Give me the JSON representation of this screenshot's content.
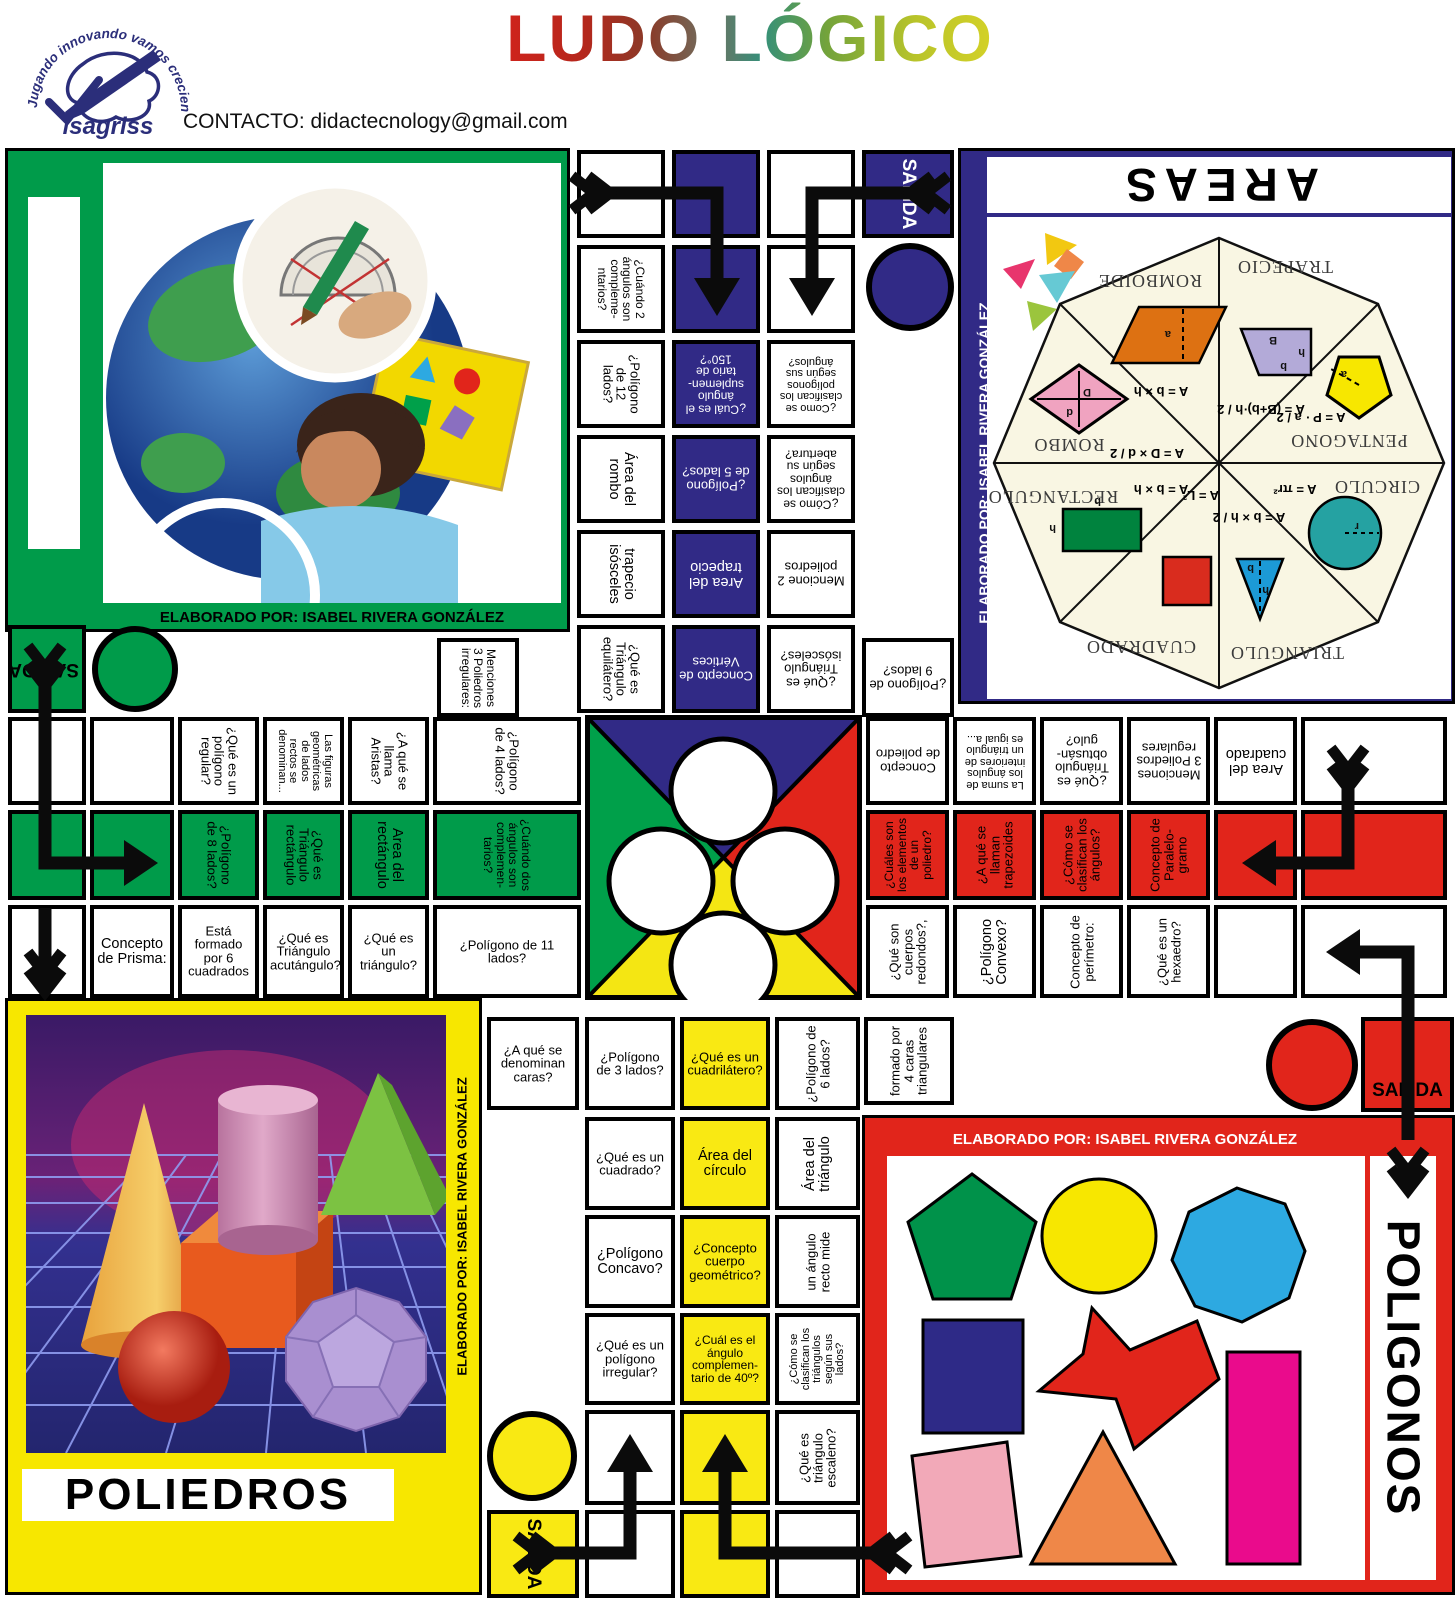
{
  "palette": {
    "navy": "#312a86",
    "green": "#009b4a",
    "red": "#e1251b",
    "yellow": "#f7e700",
    "cellYellow": "#f9e913",
    "magenta": "#ea0b8c",
    "skyBlue": "#2da9e1",
    "pink": "#f2a9b8",
    "orange": "#ef8748",
    "cream": "#f9f6e3"
  },
  "header": {
    "title": "LUDO LÓGICO",
    "contact": "CONTACTO: didactecnology@gmail.com",
    "logo_brand": "isagriss",
    "logo_motto": "Jugando  innovando  vamos  creciendo"
  },
  "quadrants": {
    "taller": {
      "credit": "ELABORADO POR: ISABEL RIVERA GONZÁLEZ"
    },
    "areas": {
      "title": "AREAS",
      "credit": "ELABORADO POR: ISABEL RIVERA GONZÁLEZ",
      "dims": {
        "b": "b",
        "B": "B",
        "h": "h",
        "D": "D",
        "d": "d",
        "a": "a",
        "r": "r",
        "l": "l"
      },
      "wheel": [
        {
          "name": "TRAPECIO",
          "formula": "A = (B+b)·h / 2"
        },
        {
          "name": "ROMBOIDE",
          "formula": "A = b × h"
        },
        {
          "name": "ROMBO",
          "formula": "A = D × d / 2"
        },
        {
          "name": "PENTAGONO",
          "formula": "A = P · a / 2"
        },
        {
          "name": "RECTANGULO",
          "formula": "A = b × h"
        },
        {
          "name": "CIRCULO",
          "formula": "A = πr²"
        },
        {
          "name": "CUADRADO",
          "formula": "A = L²"
        },
        {
          "name": "TRIANGULO",
          "formula": "A = b × h / 2"
        }
      ]
    },
    "poliedros": {
      "title": "POLIEDROS",
      "credit": "ELABORADO POR: ISABEL RIVERA GONZÁLEZ"
    },
    "poligonos": {
      "title": "POLIGONOS",
      "credit": "ELABORADO POR: ISABEL RIVERA GONZÁLEZ"
    }
  },
  "board": {
    "cells": [
      {
        "x": 577,
        "y": 150,
        "w": 88,
        "h": 88
      },
      {
        "t": "¿Cuándo 2 ángulos son compleme- ntarios?",
        "x": 577,
        "y": 245,
        "w": 88,
        "h": 88,
        "rot": 90
      },
      {
        "t": "¿Polígono de 12 lados?",
        "x": 577,
        "y": 340,
        "w": 88,
        "h": 88,
        "rot": 90
      },
      {
        "t": "Área del rombo",
        "x": 577,
        "y": 435,
        "w": 88,
        "h": 88,
        "rot": 90
      },
      {
        "t": "trapecio isósceles",
        "x": 577,
        "y": 530,
        "w": 88,
        "h": 88,
        "rot": 90
      },
      {
        "t": "¿Qué es Triángulo equilátero?",
        "x": 577,
        "y": 625,
        "w": 88,
        "h": 88,
        "rot": 90
      },
      {
        "x": 672,
        "y": 150,
        "w": 88,
        "h": 88,
        "bg": "n"
      },
      {
        "x": 672,
        "y": 245,
        "w": 88,
        "h": 88,
        "bg": "n"
      },
      {
        "t": "¿Cuál es el ángulo suplemen- tario de 150°?",
        "x": 672,
        "y": 340,
        "w": 88,
        "h": 88,
        "bg": "n",
        "rot": 180,
        "fg": "#fff"
      },
      {
        "t": "¿Polígono de 5 lados?",
        "x": 672,
        "y": 435,
        "w": 88,
        "h": 88,
        "bg": "n",
        "rot": 180,
        "fg": "#fff"
      },
      {
        "t": "Area del trapecio",
        "x": 672,
        "y": 530,
        "w": 88,
        "h": 88,
        "bg": "n",
        "rot": 180,
        "fg": "#fff"
      },
      {
        "t": "Concepto de Vértices",
        "x": 672,
        "y": 625,
        "w": 88,
        "h": 88,
        "bg": "n",
        "rot": 180,
        "fg": "#fff"
      },
      {
        "x": 767,
        "y": 150,
        "w": 88,
        "h": 88
      },
      {
        "x": 767,
        "y": 245,
        "w": 88,
        "h": 88
      },
      {
        "t": "¿Como se clasifican los polígonos según sus ángulos?",
        "x": 767,
        "y": 340,
        "w": 88,
        "h": 88,
        "rot": 180
      },
      {
        "t": "¿Cómo se clasifican los ángulos según su abertura?",
        "x": 767,
        "y": 435,
        "w": 88,
        "h": 88,
        "rot": 180
      },
      {
        "t": "Mencione 2 poliedros",
        "x": 767,
        "y": 530,
        "w": 88,
        "h": 88,
        "rot": 180
      },
      {
        "t": "¿Qué es Triángulo isósceles?",
        "x": 767,
        "y": 625,
        "w": 88,
        "h": 88,
        "rot": 180
      },
      {
        "t": "SALIDA",
        "x": 862,
        "y": 150,
        "w": 92,
        "h": 88,
        "bg": "n",
        "rot": 90,
        "fg": "#fff",
        "kind": "salida"
      },
      {
        "t": "¿Polígono de 9 lados?",
        "x": 862,
        "y": 638,
        "w": 92,
        "h": 79,
        "rot": 180
      },
      {
        "t": "SALIDA",
        "x": 8,
        "y": 625,
        "w": 78,
        "h": 88,
        "bg": "g",
        "rot": 180,
        "kind": "salida"
      },
      {
        "t": "Menciones 3 Poliedros irregulares:",
        "x": 437,
        "y": 638,
        "w": 82,
        "h": 79,
        "rot": 90
      },
      {
        "x": 8,
        "y": 717,
        "w": 78,
        "h": 88
      },
      {
        "x": 90,
        "y": 717,
        "w": 84,
        "h": 88
      },
      {
        "t": "¿Qué es un polígono regular?",
        "x": 178,
        "y": 717,
        "w": 81,
        "h": 88,
        "rot": 90
      },
      {
        "t": "Las figuras geométricas de lados rectos se denominan...",
        "x": 263,
        "y": 717,
        "w": 81,
        "h": 88,
        "rot": 90
      },
      {
        "t": "¿A qué se llama Aristas?",
        "x": 348,
        "y": 717,
        "w": 81,
        "h": 88,
        "rot": 90
      },
      {
        "t": "¿Polígono de 4 lados?",
        "x": 433,
        "y": 717,
        "w": 148,
        "h": 88,
        "rot": 90
      },
      {
        "x": 8,
        "y": 810,
        "w": 78,
        "h": 90,
        "bg": "g"
      },
      {
        "x": 90,
        "y": 810,
        "w": 84,
        "h": 90,
        "bg": "g"
      },
      {
        "t": "¿Polígono de 8 lados?",
        "x": 178,
        "y": 810,
        "w": 81,
        "h": 90,
        "bg": "g",
        "rot": 90
      },
      {
        "t": "¿Qué es Triángulo rectángulo",
        "x": 263,
        "y": 810,
        "w": 81,
        "h": 90,
        "bg": "g",
        "rot": 90
      },
      {
        "t": "Area del rectángulo",
        "x": 348,
        "y": 810,
        "w": 81,
        "h": 90,
        "bg": "g",
        "rot": 90
      },
      {
        "t": "¿Cuándo dos ángulos son complemen- tarios?",
        "x": 433,
        "y": 810,
        "w": 148,
        "h": 90,
        "bg": "g",
        "rot": 90
      },
      {
        "x": 8,
        "y": 905,
        "w": 78,
        "h": 93
      },
      {
        "t": "Concepto de Prisma:",
        "x": 90,
        "y": 905,
        "w": 84,
        "h": 93
      },
      {
        "t": "Está formado por 6 cuadrados",
        "x": 178,
        "y": 905,
        "w": 81,
        "h": 93
      },
      {
        "t": "¿Qué es Triángulo acutángulo?",
        "x": 263,
        "y": 905,
        "w": 81,
        "h": 93
      },
      {
        "t": "¿Qué es un triángulo?",
        "x": 348,
        "y": 905,
        "w": 81,
        "h": 93
      },
      {
        "t": "¿Polígono de 11 lados?",
        "x": 433,
        "y": 905,
        "w": 148,
        "h": 93
      },
      {
        "t": "Concepto de poliedro",
        "x": 866,
        "y": 717,
        "w": 83,
        "h": 88,
        "rot": 180
      },
      {
        "t": "La suma de los ángulos interiores de un triángulo es igual a...",
        "x": 953,
        "y": 717,
        "w": 83,
        "h": 88,
        "rot": 180
      },
      {
        "t": "¿Qué es Triángulo obtusán- gulo?",
        "x": 1040,
        "y": 717,
        "w": 83,
        "h": 88,
        "rot": 180
      },
      {
        "t": "Menciones 3 Poliedros regulares",
        "x": 1127,
        "y": 717,
        "w": 83,
        "h": 88,
        "rot": 180
      },
      {
        "t": "Area del cuadrado",
        "x": 1214,
        "y": 717,
        "w": 83,
        "h": 88,
        "rot": 180
      },
      {
        "x": 1301,
        "y": 717,
        "w": 146,
        "h": 88
      },
      {
        "t": "¿Cuáles son los elementos de un poliedro?",
        "x": 866,
        "y": 810,
        "w": 83,
        "h": 90,
        "bg": "r",
        "rot": -90
      },
      {
        "t": "¿A qué se llaman trapezoides",
        "x": 953,
        "y": 810,
        "w": 83,
        "h": 90,
        "bg": "r",
        "rot": -90
      },
      {
        "t": "¿Cómo se clasifican los ángulos?",
        "x": 1040,
        "y": 810,
        "w": 83,
        "h": 90,
        "bg": "r",
        "rot": -90
      },
      {
        "t": "Concepto de Paralelo- gramo",
        "x": 1127,
        "y": 810,
        "w": 83,
        "h": 90,
        "bg": "r",
        "rot": -90
      },
      {
        "x": 1214,
        "y": 810,
        "w": 83,
        "h": 90,
        "bg": "r"
      },
      {
        "x": 1301,
        "y": 810,
        "w": 146,
        "h": 90,
        "bg": "r"
      },
      {
        "t": "¿Qué son cuerpos redondos?,",
        "x": 866,
        "y": 905,
        "w": 83,
        "h": 93,
        "rot": -90
      },
      {
        "t": "¿Polígono Convexo?",
        "x": 953,
        "y": 905,
        "w": 83,
        "h": 93,
        "rot": -90
      },
      {
        "t": "Concepto de perímetro:",
        "x": 1040,
        "y": 905,
        "w": 83,
        "h": 93,
        "rot": -90
      },
      {
        "t": "¿Qué es un hexaedro?",
        "x": 1127,
        "y": 905,
        "w": 83,
        "h": 93,
        "rot": -90
      },
      {
        "x": 1214,
        "y": 905,
        "w": 83,
        "h": 93
      },
      {
        "x": 1301,
        "y": 905,
        "w": 146,
        "h": 93
      },
      {
        "t": "¿A qué se denominan caras?",
        "x": 487,
        "y": 1017,
        "w": 92,
        "h": 93
      },
      {
        "t": "¿Polígono de 3 lados?",
        "x": 585,
        "y": 1017,
        "w": 90,
        "h": 93
      },
      {
        "t": "¿Qué es un cuadrilátero?",
        "x": 680,
        "y": 1017,
        "w": 90,
        "h": 93,
        "bg": "y"
      },
      {
        "t": "¿Polígono de 6 lados?",
        "x": 775,
        "y": 1017,
        "w": 85,
        "h": 93,
        "rot": -90
      },
      {
        "t": "¿Qué es un cuadrado?",
        "x": 585,
        "y": 1117,
        "w": 90,
        "h": 93
      },
      {
        "t": "Área del círculo",
        "x": 680,
        "y": 1117,
        "w": 90,
        "h": 93,
        "bg": "y"
      },
      {
        "t": "Área del triángulo",
        "x": 775,
        "y": 1117,
        "w": 85,
        "h": 93,
        "rot": -90
      },
      {
        "t": "¿Polígono Concavo?",
        "x": 585,
        "y": 1215,
        "w": 90,
        "h": 93
      },
      {
        "t": "¿Concepto cuerpo geométrico?",
        "x": 680,
        "y": 1215,
        "w": 90,
        "h": 93,
        "bg": "y"
      },
      {
        "t": "un ángulo recto mide",
        "x": 775,
        "y": 1215,
        "w": 85,
        "h": 93,
        "rot": -90
      },
      {
        "t": "¿Qué es un polígono irregular?",
        "x": 585,
        "y": 1313,
        "w": 90,
        "h": 92
      },
      {
        "t": "¿Cuál es el ángulo complemen- tario de 40º?",
        "x": 680,
        "y": 1313,
        "w": 90,
        "h": 92,
        "bg": "y"
      },
      {
        "t": "¿Cómo se clasifican los triángulos según sus lados?",
        "x": 775,
        "y": 1313,
        "w": 85,
        "h": 92,
        "rot": -90
      },
      {
        "x": 585,
        "y": 1410,
        "w": 90,
        "h": 95
      },
      {
        "x": 680,
        "y": 1410,
        "w": 90,
        "h": 95,
        "bg": "y"
      },
      {
        "t": "¿Qué es triángulo escaleno?",
        "x": 775,
        "y": 1410,
        "w": 85,
        "h": 95,
        "rot": -90
      },
      {
        "x": 585,
        "y": 1510,
        "w": 90,
        "h": 88
      },
      {
        "x": 680,
        "y": 1510,
        "w": 90,
        "h": 88,
        "bg": "y"
      },
      {
        "x": 775,
        "y": 1510,
        "w": 85,
        "h": 88
      },
      {
        "t": "SALIDA",
        "x": 487,
        "y": 1510,
        "w": 92,
        "h": 88,
        "bg": "y",
        "rot": 90,
        "kind": "salida"
      },
      {
        "t": "formado por 4 caras triangulares",
        "x": 864,
        "y": 1017,
        "w": 90,
        "h": 88,
        "rot": -90
      },
      {
        "t": "SALIDA",
        "x": 1361,
        "y": 1017,
        "w": 93,
        "h": 95,
        "bg": "r",
        "kind": "salida",
        "dy": 80
      }
    ],
    "circles": [
      {
        "x": 866,
        "y": 243,
        "d": 88,
        "c": "navy"
      },
      {
        "x": 92,
        "y": 626,
        "d": 86,
        "c": "green"
      },
      {
        "x": 487,
        "y": 1411,
        "d": 90,
        "c": "cellYellow"
      },
      {
        "x": 1266,
        "y": 1019,
        "d": 92,
        "c": "red"
      }
    ]
  }
}
